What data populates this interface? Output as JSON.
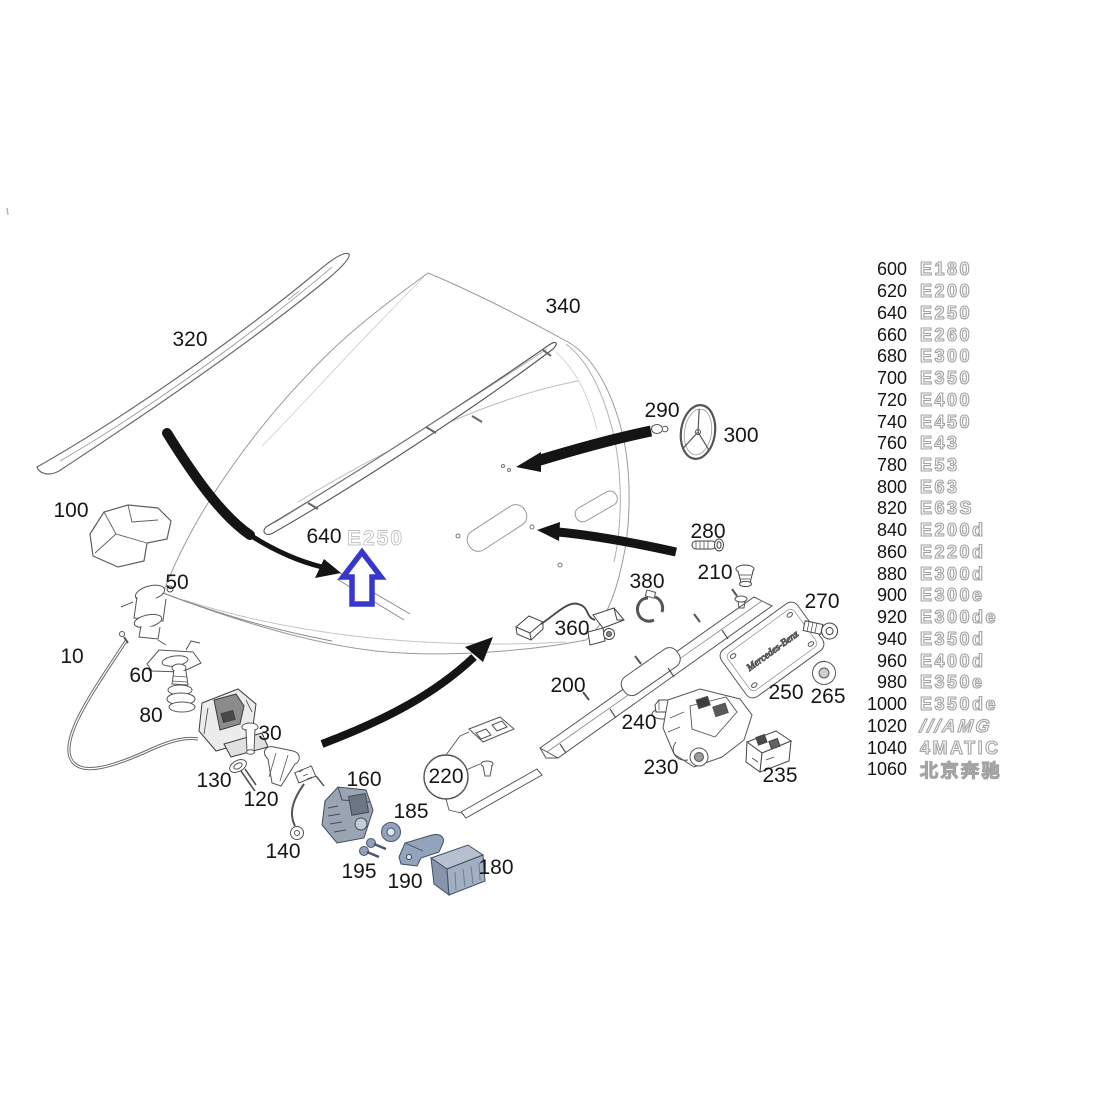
{
  "diagram": {
    "lid_emblem": {
      "code": "640",
      "badge": "E250"
    },
    "plate_text": "Mercedes-Benz",
    "part_labels": [
      {
        "label": "320",
        "x": 190,
        "y": 340
      },
      {
        "label": "340",
        "x": 563,
        "y": 307
      },
      {
        "label": "290",
        "x": 662,
        "y": 411
      },
      {
        "label": "300",
        "x": 741,
        "y": 436
      },
      {
        "label": "100",
        "x": 71,
        "y": 511
      },
      {
        "label": "50",
        "x": 177,
        "y": 583
      },
      {
        "label": "640",
        "x": 324,
        "y": 537
      },
      {
        "label": "280",
        "x": 708,
        "y": 532
      },
      {
        "label": "210",
        "x": 715,
        "y": 573
      },
      {
        "label": "380",
        "x": 647,
        "y": 582
      },
      {
        "label": "270",
        "x": 822,
        "y": 602
      },
      {
        "label": "10",
        "x": 72,
        "y": 657
      },
      {
        "label": "60",
        "x": 141,
        "y": 676
      },
      {
        "label": "360",
        "x": 572,
        "y": 629
      },
      {
        "label": "80",
        "x": 151,
        "y": 716
      },
      {
        "label": "30",
        "x": 270,
        "y": 734
      },
      {
        "label": "200",
        "x": 568,
        "y": 686
      },
      {
        "label": "240",
        "x": 639,
        "y": 723
      },
      {
        "label": "250",
        "x": 786,
        "y": 693
      },
      {
        "label": "265",
        "x": 828,
        "y": 697
      },
      {
        "label": "130",
        "x": 214,
        "y": 781
      },
      {
        "label": "120",
        "x": 261,
        "y": 800
      },
      {
        "label": "230",
        "x": 661,
        "y": 768
      },
      {
        "label": "235",
        "x": 780,
        "y": 776
      },
      {
        "label": "160",
        "x": 364,
        "y": 780
      },
      {
        "label": "220",
        "x": 446,
        "y": 777
      },
      {
        "label": "185",
        "x": 411,
        "y": 812
      },
      {
        "label": "140",
        "x": 283,
        "y": 852
      },
      {
        "label": "195",
        "x": 359,
        "y": 872
      },
      {
        "label": "190",
        "x": 405,
        "y": 882
      },
      {
        "label": "180",
        "x": 496,
        "y": 868
      }
    ],
    "colors": {
      "highlight_arrow_blue": "#3737cf",
      "pointer_arrow_black": "#141414",
      "tinted_part_blue_gray": "#93a3bb",
      "line_art_gray": "#555555"
    }
  },
  "emblem_list": {
    "rows": [
      {
        "code": "600",
        "badge": "E180",
        "italic": false
      },
      {
        "code": "620",
        "badge": "E200",
        "italic": false
      },
      {
        "code": "640",
        "badge": "E250",
        "italic": false
      },
      {
        "code": "660",
        "badge": "E260",
        "italic": false
      },
      {
        "code": "680",
        "badge": "E300",
        "italic": false
      },
      {
        "code": "700",
        "badge": "E350",
        "italic": false
      },
      {
        "code": "720",
        "badge": "E400",
        "italic": false
      },
      {
        "code": "740",
        "badge": "E450",
        "italic": false
      },
      {
        "code": "760",
        "badge": "E43",
        "italic": false
      },
      {
        "code": "780",
        "badge": "E53",
        "italic": false
      },
      {
        "code": "800",
        "badge": "E63",
        "italic": false
      },
      {
        "code": "820",
        "badge": "E63S",
        "italic": false
      },
      {
        "code": "840",
        "badge": "E200d",
        "italic": false
      },
      {
        "code": "860",
        "badge": "E220d",
        "italic": false
      },
      {
        "code": "880",
        "badge": "E300d",
        "italic": false
      },
      {
        "code": "900",
        "badge": "E300e",
        "italic": false
      },
      {
        "code": "920",
        "badge": "E300de",
        "italic": false
      },
      {
        "code": "940",
        "badge": "E350d",
        "italic": false
      },
      {
        "code": "960",
        "badge": "E400d",
        "italic": false
      },
      {
        "code": "980",
        "badge": "E350e",
        "italic": false
      },
      {
        "code": "1000",
        "badge": "E350de",
        "italic": false
      },
      {
        "code": "1020",
        "badge": "///AMG",
        "italic": true
      },
      {
        "code": "1040",
        "badge": "4MATIC",
        "italic": false
      },
      {
        "code": "1060",
        "badge": "北京奔驰",
        "italic": false
      }
    ]
  }
}
